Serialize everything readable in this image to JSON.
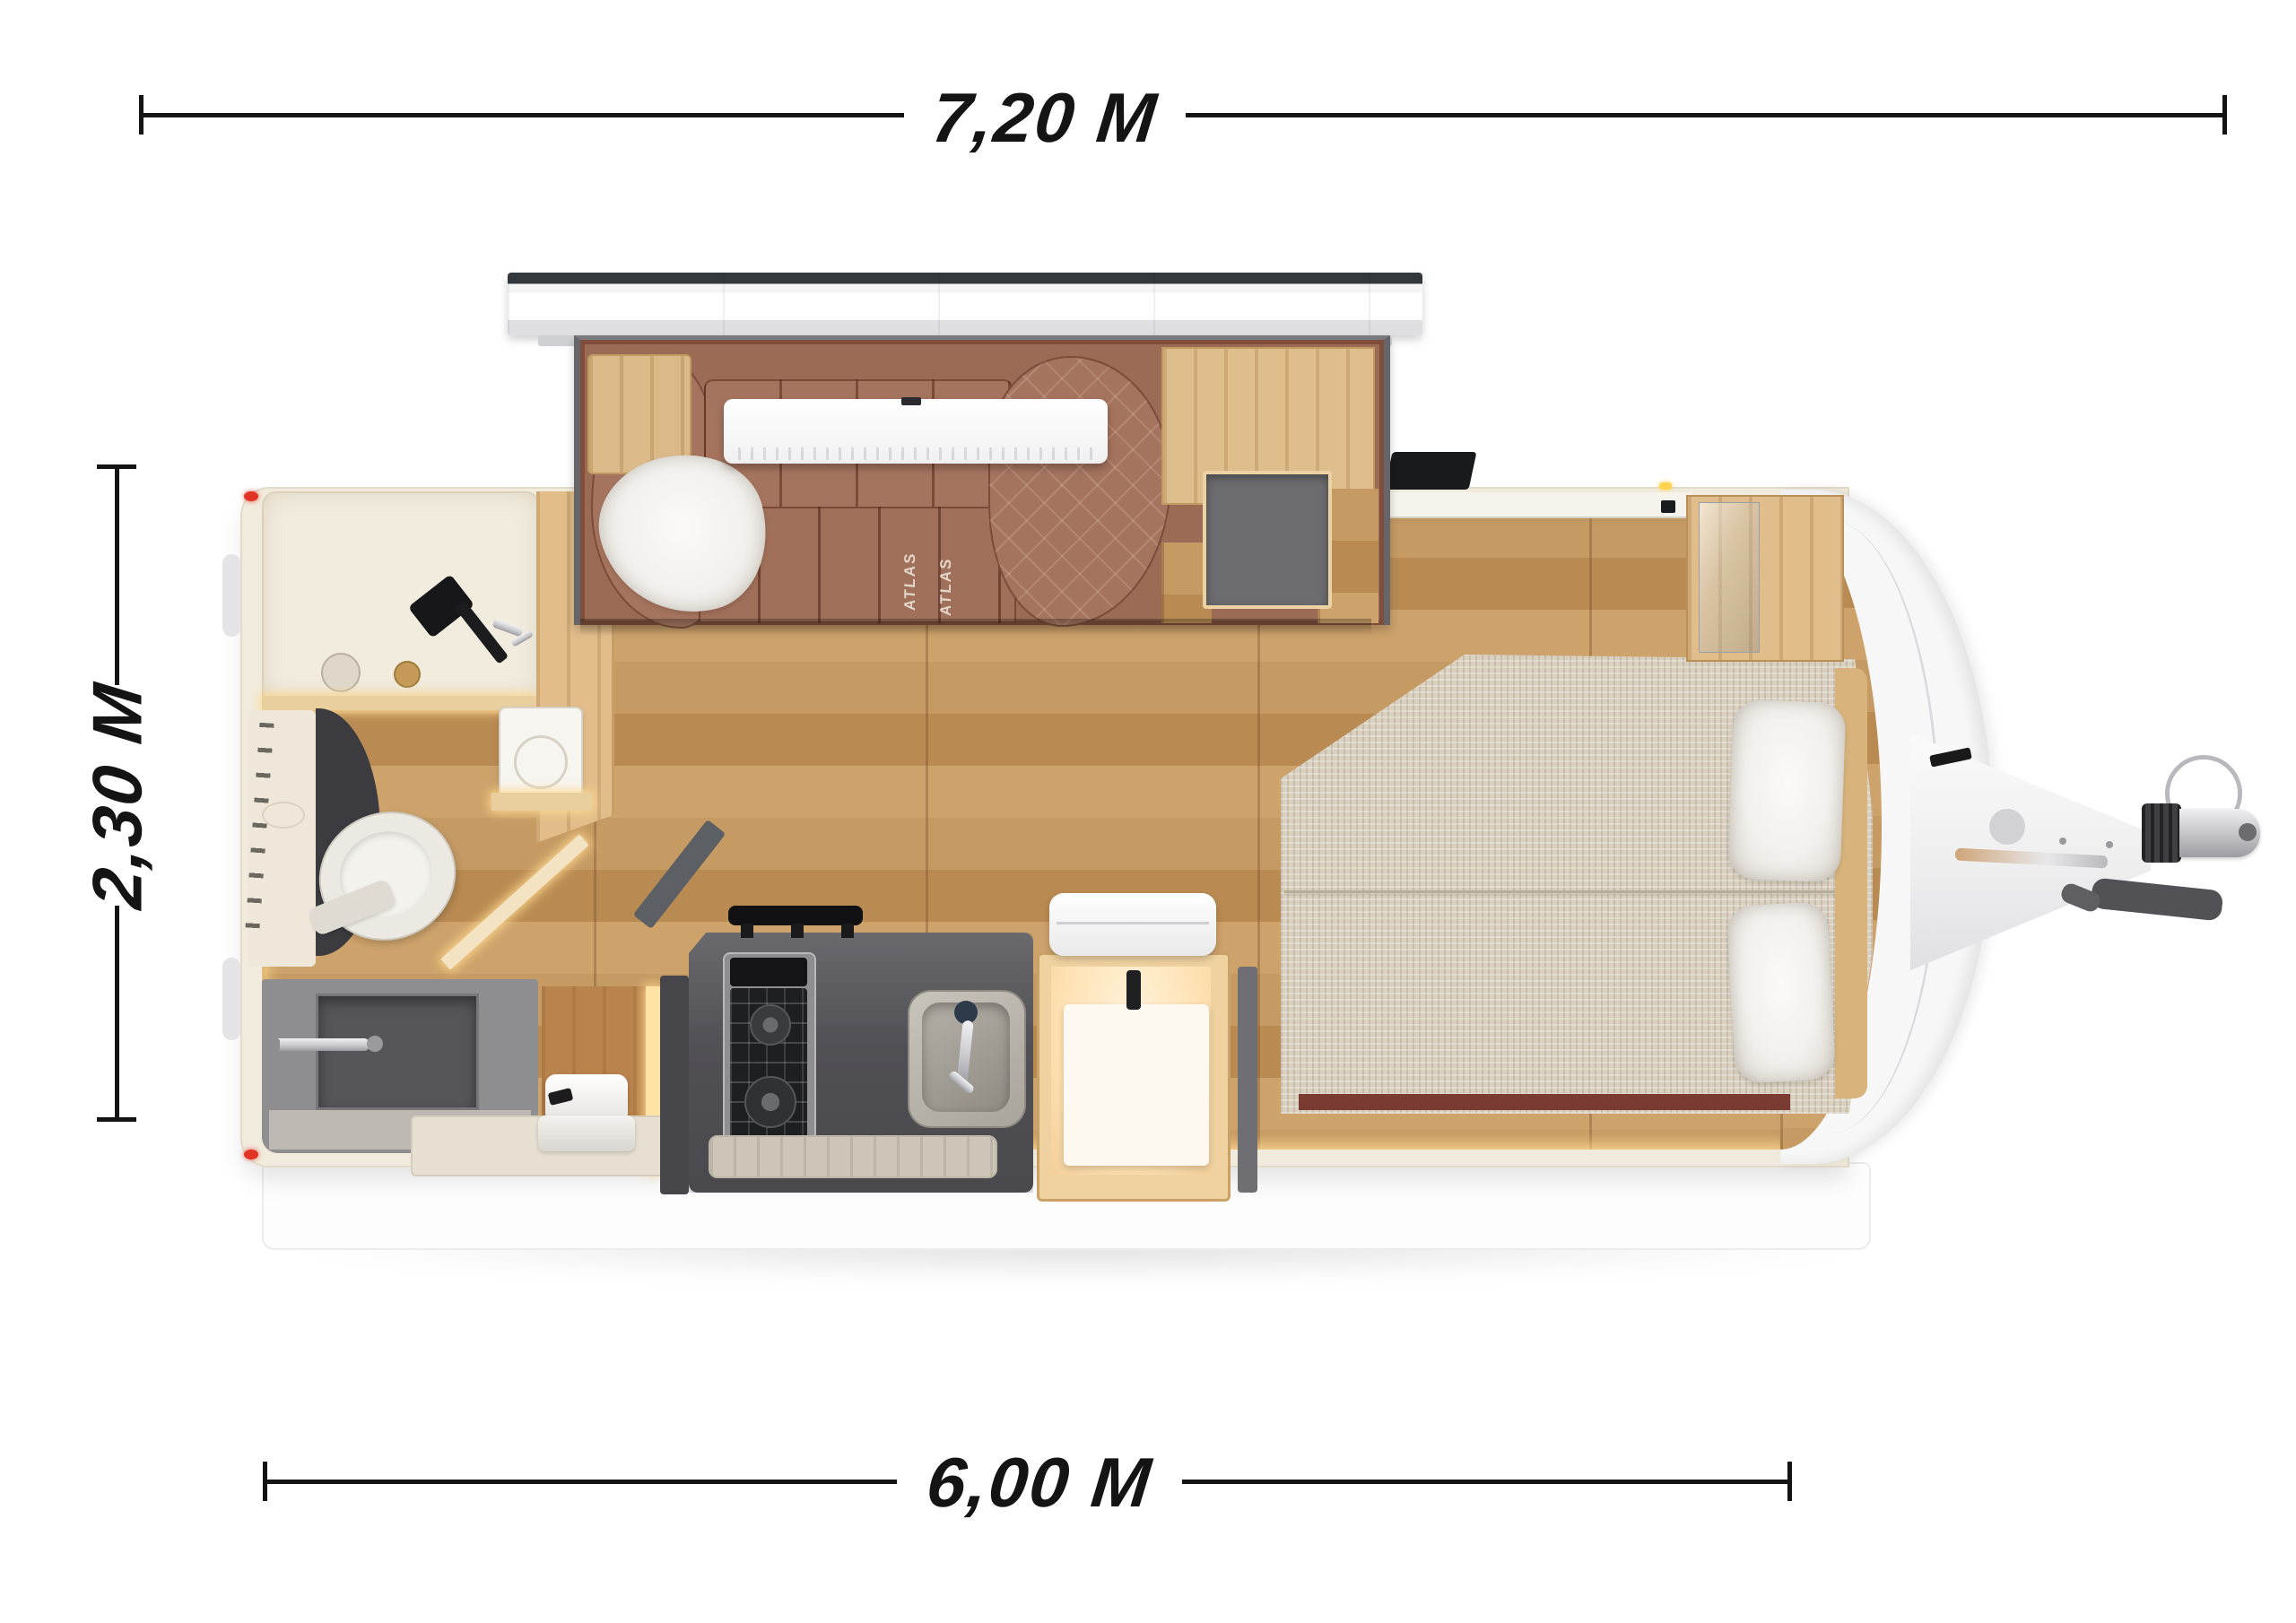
{
  "diagram": {
    "type": "caravan-floorplan-top-view",
    "dimensions": {
      "total_length_label": "7,20 M",
      "body_length_label": "6,00 M",
      "width_label": "2,30 M"
    },
    "branding": {
      "sofa_logo_left": "ATLAS",
      "sofa_logo_right": "ATLAS"
    },
    "palette": {
      "ink": "#141414",
      "wall": "#f1ebdd",
      "woodTrim": "#e9cf9e",
      "floorA": "#c59a63",
      "floorB": "#b98b52",
      "floorC": "#cda26b",
      "glow": "#ffd98f",
      "sofa": "#9c6b56",
      "sofaCushion": "#a5745e",
      "sofaSeam": "rgba(80,35,20,0.5)",
      "counter": "#59585c",
      "steel": "#8e8e92",
      "cream": "#f2ecdf",
      "grayFixture": "#8e8e91",
      "mattress": "#d9d0c0",
      "pillow": "#f2f0ec",
      "capWhite": "#f7f7f8",
      "slideFrame": "#66666a",
      "red": "#e23425",
      "maroon": "#7a3b33",
      "yellow": "#ffd34d",
      "chrome": "#c9c9ce"
    }
  }
}
